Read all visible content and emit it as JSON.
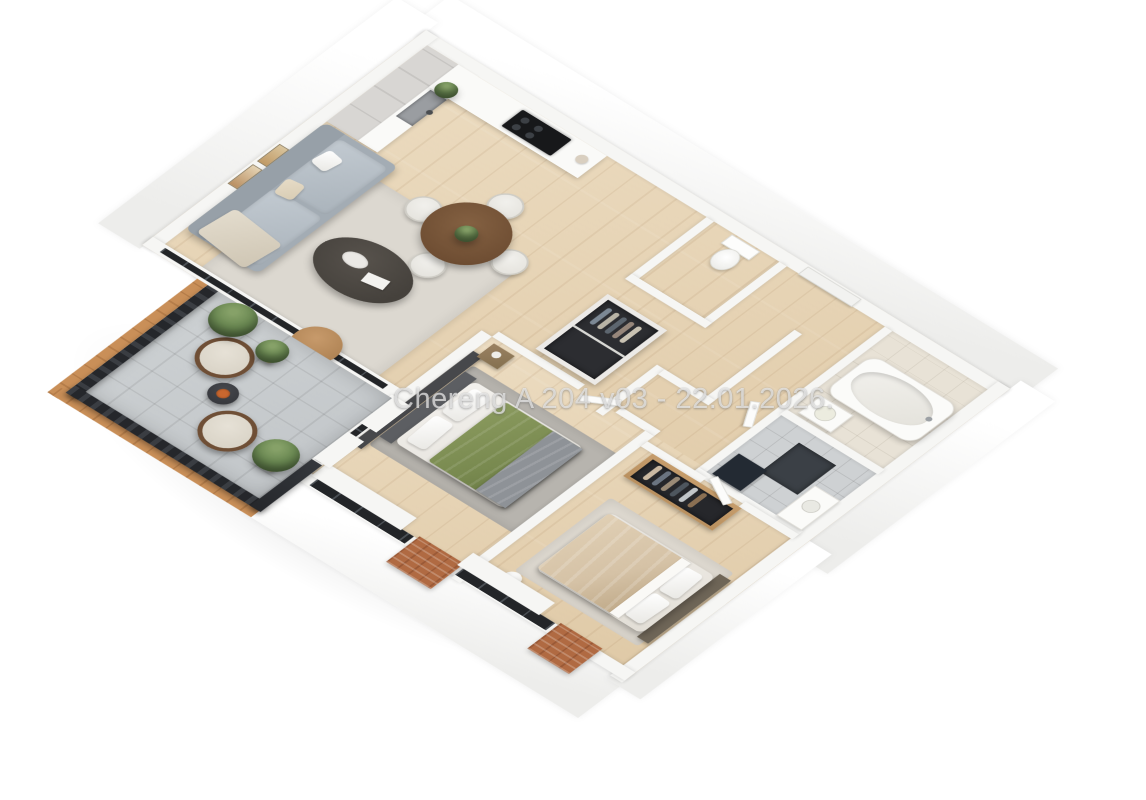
{
  "watermark": {
    "text": "Chereng A 204 v03 - 22.01.2026."
  },
  "palette": {
    "wall": "#f6f6f4",
    "wood-floor": "#ecdcc1",
    "wood-floor-deep": "#dfc9a6",
    "bath-tile": "#e8e2d6",
    "shower-tile": "#ced1d3",
    "balcony-tile": "#c2c6c9",
    "railing": "#25272b",
    "wood-trim": "#c98f58",
    "brick": "#b06a42",
    "window-glass": "#232528",
    "sofa": "#a3acb4",
    "rug-living": "#dcd8d0",
    "rug-bedroom": "#b7b4ae",
    "duvet-green": "#78894f",
    "duvet-beige": "#d5c2a6",
    "accent-wall": "#47484b",
    "closet-dark": "#2c2d31",
    "wardrobe-wood": "#b9905f",
    "plant": "#5d7a48",
    "pouf": "#b08455",
    "table-wood": "#6f4e33",
    "coffee-table": "#45413c",
    "cabinet": "#d8d6d3",
    "counter": "#fafaf8",
    "cooktop": "#17181a"
  }
}
